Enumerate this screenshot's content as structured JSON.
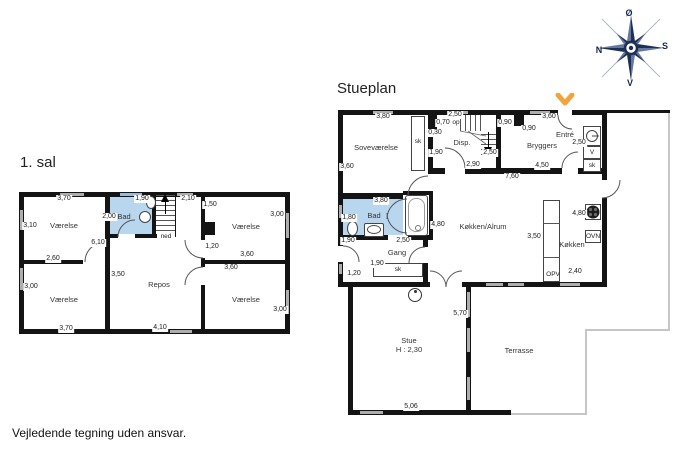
{
  "page": {
    "footer": "Vejledende tegning uden ansvar."
  },
  "compass": {
    "east": "Ø",
    "south": "S",
    "west": "V",
    "north": "N"
  },
  "first_floor": {
    "title": "1. sal",
    "rooms": {
      "top_left": "Værelse",
      "bad": "Bad",
      "top_right": "Værelse",
      "bottom_left": "Værelse",
      "repos": "Repos",
      "bottom_right": "Værelse"
    },
    "stairs": {
      "label": "ned"
    },
    "dims": {
      "tl_top": "3,70",
      "bad_top": "1,90",
      "stairs_top": "2,10",
      "tl_left": "3,10",
      "bad_left": "2,00",
      "tr_left": "1,50",
      "tr_right": "3,00",
      "mid_height": "6,10",
      "tl_bottom": "2,60",
      "tr_door": "1,20",
      "tr_bottom": "3,60",
      "br_top": "3,60",
      "repos_left": "3,50",
      "bl_left": "3,00",
      "bl_bottom": "3,70",
      "repos_bottom": "4,10",
      "br_right": "3,00"
    }
  },
  "ground_floor": {
    "title": "Stueplan",
    "rooms": {
      "sovevaerelse": "Soveværelse",
      "disp": "Disp.",
      "bryggers": "Bryggers",
      "entre": "Entré",
      "bad": "Bad",
      "kokken_alrum": "Køkken/Alrum",
      "gang": "Gang",
      "kokken": "Køkken",
      "stue": "Stue",
      "stue_height": "H : 2,30",
      "terrasse": "Terrasse"
    },
    "closets": {
      "sovevaerelse_sk": "sk",
      "entre_v": "V",
      "entre_sk": "sk",
      "gang_sk": "sk"
    },
    "appliances": {
      "oven": "OVN",
      "dishwasher": "OPV"
    },
    "stairs": {
      "label": "op"
    },
    "dims": {
      "sove_top": "3,80",
      "stairs_top": "2,50",
      "duct_w": "0,70",
      "duct_d": "0,30",
      "chimney_l": "0,90",
      "chimney_r": "0,90",
      "bryggers_top": "3,60",
      "entre": "2,50",
      "sove_left": "3,60",
      "disp_left": "1,90",
      "stairs_bottom": "2,50",
      "disp_bottom": "2,90",
      "bryggers_bottom": "4,50",
      "total_width": "7,60",
      "bad_top": "3,80",
      "bad_left": "1,80",
      "bad_below": "1,90",
      "bad_door": "2,50",
      "alrum_height": "4,80",
      "gang": "1,90",
      "gang_left": "1,20",
      "kokken_width": "3,50",
      "kokken_right": "4,80",
      "kokken_bottom": "2,40",
      "stue_right": "5,70",
      "stue_bottom": "5,06"
    }
  }
}
